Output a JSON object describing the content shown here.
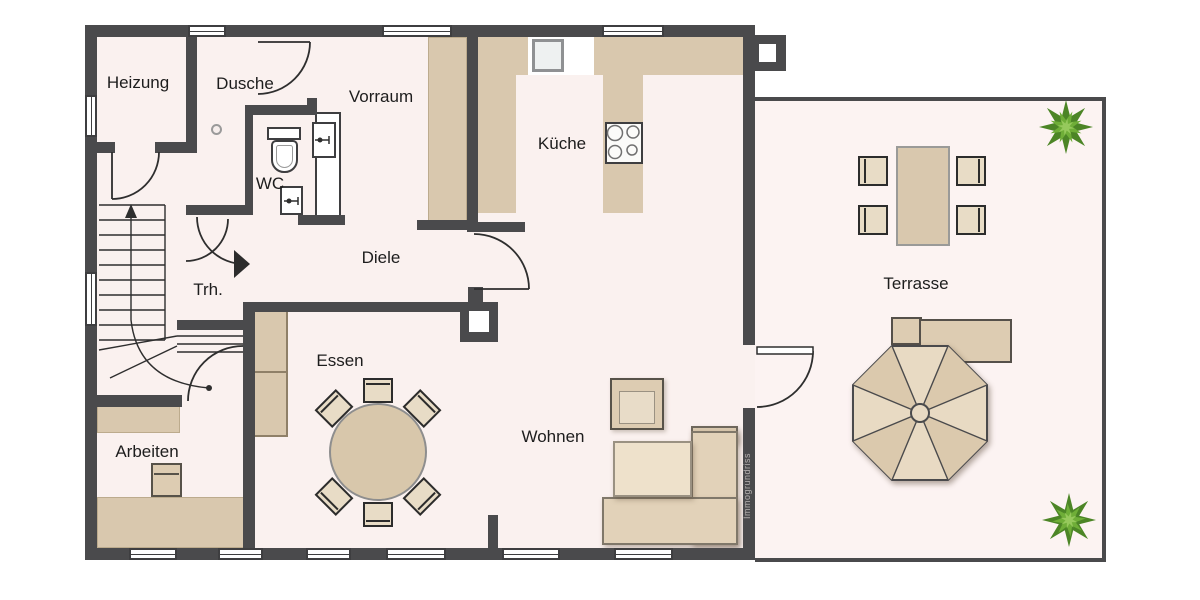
{
  "watermark": {
    "text": "Immogrundriss"
  },
  "rooms": {
    "heizung": {
      "label": "Heizung"
    },
    "dusche": {
      "label": "Dusche"
    },
    "vorraum": {
      "label": "Vorraum"
    },
    "wc": {
      "label": "WC"
    },
    "kueche": {
      "label": "Küche"
    },
    "diele": {
      "label": "Diele"
    },
    "trh": {
      "label": "Trh."
    },
    "essen": {
      "label": "Essen"
    },
    "wohnen": {
      "label": "Wohnen"
    },
    "arbeiten": {
      "label": "Arbeiten"
    },
    "terrasse": {
      "label": "Terrasse"
    }
  },
  "colors": {
    "wall": "#4a4a4c",
    "floor": "#faf1ef",
    "terrace_floor": "#fcf3f2",
    "furniture_tan": "#d9c8ae",
    "furniture_light": "#e8dcc6",
    "plant_green": "#6fae38",
    "line": "#2e2e2e",
    "label_text": "#1d1d1d"
  }
}
